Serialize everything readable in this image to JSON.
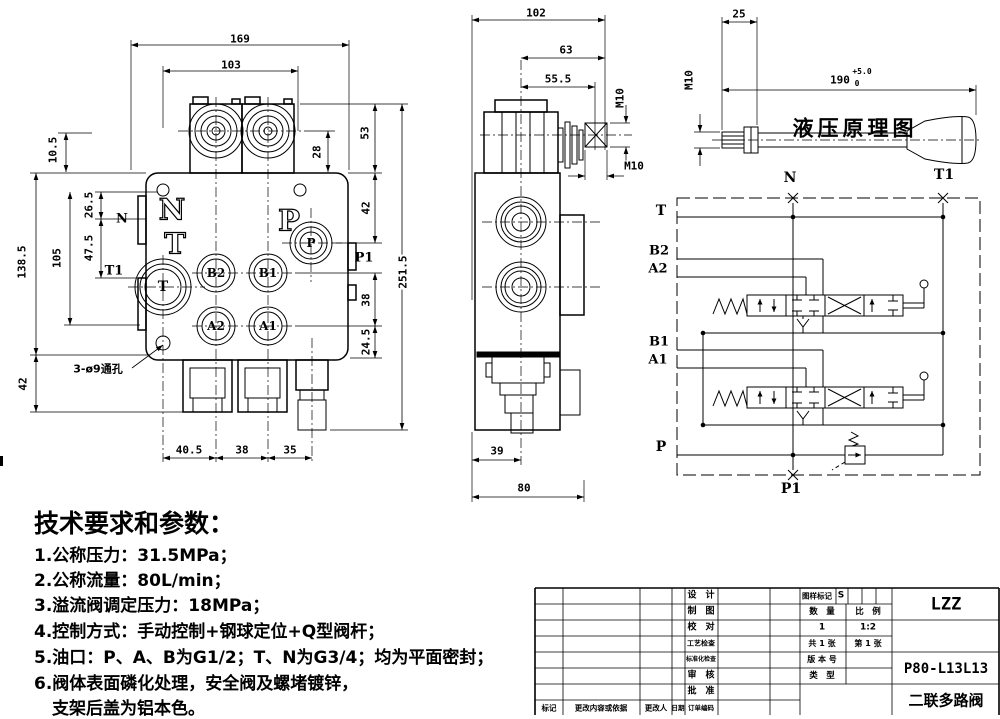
{
  "front_view": {
    "d169": "169",
    "d103": "103",
    "d10_5": "10.5",
    "d26_5": "26.5",
    "d47_5": "47.5",
    "d105": "105",
    "d138_5": "138.5",
    "d42l": "42",
    "d53": "53",
    "d28": "28",
    "d42r": "42",
    "d38r": "38",
    "d24_5": "24.5",
    "d251_5": "251.5",
    "d40_5": "40.5",
    "d38b": "38",
    "d35": "35",
    "n_ext": "N",
    "t1_ext": "T1",
    "p1_ext": "P1",
    "cast_n": "N",
    "cast_t": "T",
    "cast_p": "P",
    "port_t": "T",
    "port_b2": "B2",
    "port_b1": "B1",
    "port_a2": "A2",
    "port_a1": "A1",
    "port_p": "P",
    "hole_note": "3-ø9通孔"
  },
  "side_view": {
    "d102": "102",
    "d63": "63",
    "d55_5": "55.5",
    "m10_shaft": "M10",
    "m10_end": "M10",
    "d39": "39",
    "d80": "80"
  },
  "handle": {
    "d25": "25",
    "m10": "M10",
    "d190": "190",
    "tol_up": "+5.0",
    "tol_dn": "0"
  },
  "schematic": {
    "title": "液压原理图",
    "n": "N",
    "t1": "T1",
    "t": "T",
    "b2": "B2",
    "a2": "A2",
    "b1": "B1",
    "a1": "A1",
    "p": "P",
    "p1": "P1"
  },
  "notes": {
    "title": "技术要求和参数：",
    "l1": "1.公称压力：31.5MPa；",
    "l2": "2.公称流量：80L/min；",
    "l3": "3.溢流阀调定压力：18MPa；",
    "l4": "4.控制方式：手动控制+钢球定位+Q型阀杆；",
    "l5": "5.油口：P、A、B为G1/2；T、N为G3/4；均为平面密封；",
    "l6": "6.阀体表面磷化处理，安全阀及螺堵镀锌，",
    "l7": "支架后盖为铝本色。"
  },
  "tb": {
    "company": "LZZ",
    "model": "P80-L13L13",
    "product": "二联多路阀",
    "design": "设　计",
    "draft": "制　图",
    "check": "校　对",
    "process": "工艺检查",
    "standard": "标准化检查",
    "review": "审　核",
    "approve": "批　准",
    "order": "订单编码",
    "mark_label": "图样标记",
    "mark_value": "S",
    "qty_label": "数　量",
    "scale_label": "比　例",
    "qty": "1",
    "scale": "1:2",
    "sheets": "共 1 张",
    "sheet_no": "第 1 张",
    "version": "版 本 号",
    "type": "类　型",
    "mark2": "标记",
    "change": "更改内容或依据",
    "changer": "更改人",
    "date": "日期"
  }
}
